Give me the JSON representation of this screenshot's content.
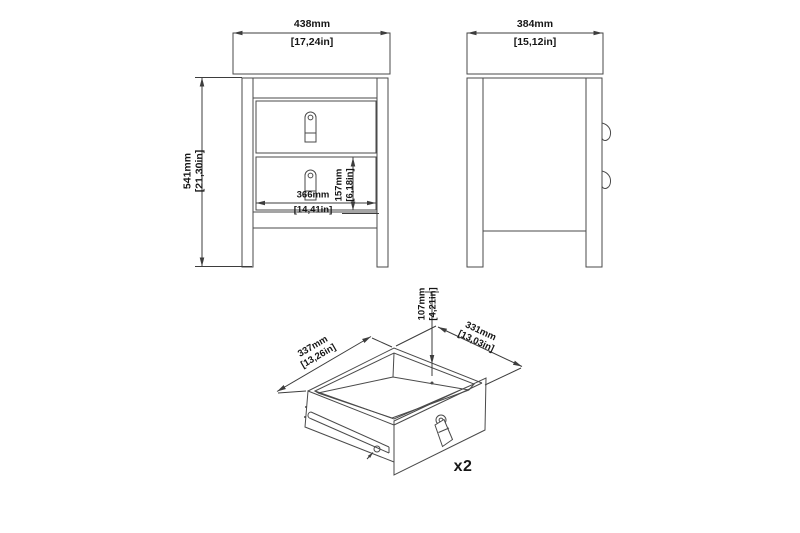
{
  "drawing": {
    "type": "furniture-assembly-technical-drawing",
    "quantity_label": "x2"
  },
  "dimensions": {
    "front_width": {
      "metric": "438mm",
      "imperial": "[17,24in]"
    },
    "front_height": {
      "metric": "541mm",
      "imperial": "[21,30in]"
    },
    "front_inner_width": {
      "metric": "366mm",
      "imperial": "[14,41in]"
    },
    "front_drawer_height": {
      "metric": "157mm",
      "imperial": "[6,18in]"
    },
    "side_width": {
      "metric": "384mm",
      "imperial": "[15,12in]"
    },
    "drawer_box_height": {
      "metric": "107mm",
      "imperial": "[4,21in]"
    },
    "drawer_box_width": {
      "metric": "337mm",
      "imperial": "[13,26in]"
    },
    "drawer_box_depth": {
      "metric": "331mm",
      "imperial": "[13,03in]"
    }
  },
  "colors": {
    "line": "#4a4a4a",
    "dimension_line": "#3d3d3d",
    "text": "#161616",
    "background": "#ffffff"
  }
}
